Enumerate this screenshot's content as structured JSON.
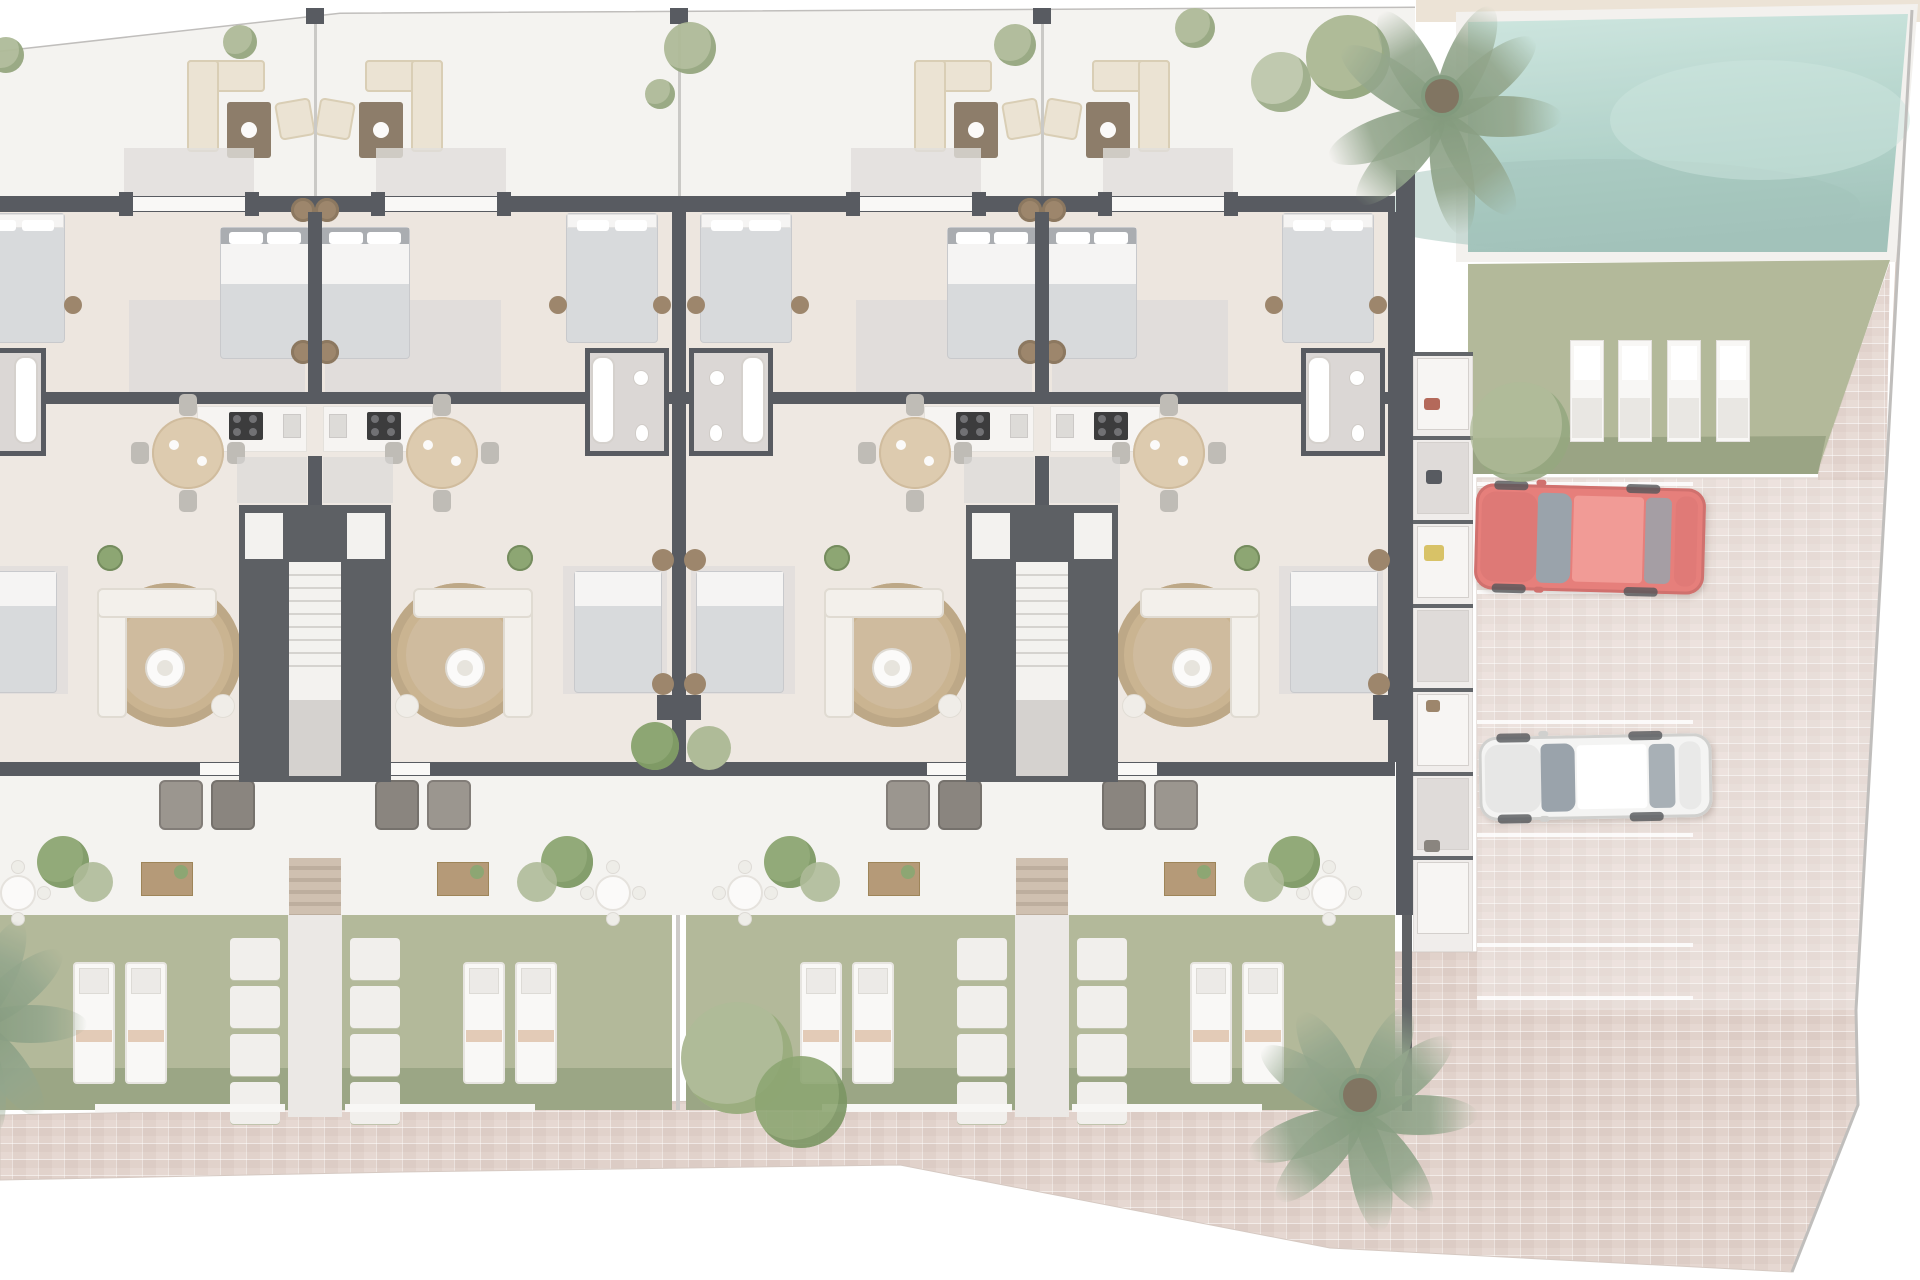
{
  "scene": {
    "type": "architectural-floor-plan",
    "view": "top-down 3d rendered site plan",
    "dwellings_visible": 4,
    "inventory": {
      "communal_pool": 1,
      "pool_sun_loungers": 4,
      "garden_sun_loungers_per_dwelling": 2,
      "cars": [
        {
          "color_name": "red"
        },
        {
          "color_name": "white"
        }
      ],
      "parking_stalls": 4,
      "palm_trees": 3,
      "double_beds_upper": 6,
      "stair_cores": 2,
      "round_dining_tables": 4,
      "round_rugs": 4
    }
  },
  "colors": {
    "page": "#ffffff",
    "terrace": "#f3f1ee",
    "terraceShadow": "#e3e0dd",
    "interiorBeige": "#eae2da",
    "interiorBeige2": "#ece5de",
    "grayFloor": "#d2d0d1",
    "wall": "#3d4047",
    "lightWall": "#f8f7f5",
    "porch": "#dcd9d6",
    "lawn": "#a7ae8a",
    "hedge": "#85926b",
    "bushBright": "#7b985c",
    "bushSoft": "#a2b088",
    "palm": "#82987a",
    "palmDark": "#6f8a68",
    "pathConcrete": "#e8e5e1",
    "steps": "#c8b6a3",
    "stone": "#efede9",
    "paving": "#dccbc3",
    "pavingLight": "#e7dad3",
    "poolRim": "#f1efec",
    "poolTop": "#c6e2da",
    "poolBottom": "#a5cbc1",
    "poolDeep": "#93b9af",
    "beigeStrip": "#e9dfd0",
    "boundary": "#b6b4b1",
    "bedDuvet": "#d2d4d7",
    "bedSheet": "#f4f3f1",
    "headboard": "#9da0a5",
    "nightstand": "#8d7354",
    "sofaBeige": "#e8dfcc",
    "sofaBeigeEdge": "#d3c6a9",
    "tableBrown": "#7b6852",
    "sideboard": "#a98a62",
    "armchairDark": "#77716a",
    "armchairDark2": "#8b857d",
    "rug": "#c7b08e",
    "rugEdge": "#b39a74",
    "diningTable": "#d8c3a2",
    "chairGray": "#b5b1ab",
    "white": "#fbfaf8",
    "counter": "#f5f3f0",
    "cooktop": "#1c1c1e",
    "stairLight": "#f2f0ed",
    "stairMid": "#cfcbc8",
    "bathFloor": "#d6d1ce",
    "redCar": "#e26a66",
    "redCarDark": "#c95a57",
    "glass": "#8a949e",
    "whiteCar": "#f3f3f2",
    "whiteCarEdge": "#d8d8d5",
    "loungerTowel": "#dcbda4",
    "curb": "#f7f6f4",
    "accentYellow": "#d2b84f",
    "accentRed": "#a8513f"
  },
  "layout": {
    "canvas": {
      "w": 1920,
      "h": 1280
    },
    "building": {
      "left": 0,
      "right": 1395,
      "clip": "0,52 340,14 1415,8 1415,1117 0,1117",
      "frontWallY": 196,
      "frontWallH": 16,
      "bedBandY": 212,
      "kitchenWallY": 392,
      "kitchenBandY": 404,
      "midWallY": 392,
      "rearWallY": 762,
      "patioY": 776,
      "gardenY": 915,
      "hedgeY": 1068,
      "gardenBottom": 1110,
      "curbY": 1106
    },
    "cores": [
      315,
      1042
    ],
    "separators": [
      {
        "x": -48,
        "sides": "right",
        "gardenBushes": false
      },
      {
        "x": 679,
        "sides": "both",
        "gardenBushes": true
      },
      {
        "x": 1395,
        "sides": "left",
        "gardenBushes": false
      }
    ],
    "terraceBushes": [
      [
        6,
        55,
        18
      ],
      [
        240,
        42,
        17
      ],
      [
        690,
        48,
        26
      ],
      [
        660,
        94,
        15
      ],
      [
        1015,
        45,
        21
      ],
      [
        1195,
        28,
        20
      ]
    ],
    "right": {
      "beigeStrip": {
        "x": 1416,
        "y": 0,
        "w": 504,
        "h": 22
      },
      "poolRim": "1456,12 1918,4 1896,262 1456,262",
      "pool": "1468,22 1908,14 1887,252 1468,252",
      "poolLawn": "1468,264 1890,260 1818,474 1468,474",
      "lawnWedge": "1890,262 1886,480 1818,480 1818,470",
      "hedgeStrip": "1468,438 1826,436 1818,474 1468,474",
      "poolLoungers": {
        "xs": [
          1570,
          1618,
          1667,
          1716
        ],
        "y": 340,
        "w": 34,
        "h": 102
      },
      "nicheStrip": {
        "x": 1413,
        "y": 352,
        "w": 60,
        "h": 600,
        "cells": 7
      },
      "buildingRightWall": {
        "x": 1396,
        "y": 170,
        "w": 20,
        "h": 745
      },
      "gardenRightWall": {
        "x": 1402,
        "y": 915,
        "w": 10,
        "h": 196
      },
      "stallLines": {
        "x": 1477,
        "w": 216,
        "ys": [
          482,
          590,
          720,
          833,
          943,
          996
        ]
      },
      "redCar": {
        "x": 1475,
        "y": 486,
        "w": 230,
        "h": 106,
        "rot": 1.5
      },
      "whiteCar": {
        "x": 1479,
        "y": 735,
        "w": 233,
        "h": 84,
        "rot": -1
      },
      "pavingPolygon": "0,1115 1360,1088 1360,952 1477,952 1477,478 1886,478 1896,262 1912,10 1886,480 1856,1010 1858,1105 1792,1272 1330,1248 900,1165 400,1172 0,1180",
      "boundaryLine": "1912,10 1886,480 1856,1010 1858,1105 1792,1272",
      "topLine": "0,52 340,14 1415,8",
      "palms": [
        {
          "cx": 1442,
          "cy": 96,
          "r": 120,
          "name": "pool-palm"
        },
        {
          "cx": 1360,
          "cy": 1095,
          "r": 118,
          "name": "paving-palm"
        },
        {
          "cx": -25,
          "cy": 1005,
          "r": 112,
          "name": "garden-palm"
        }
      ],
      "bushes": [
        {
          "cx": 1281,
          "cy": 82,
          "r": 30,
          "soft": true
        },
        {
          "cx": 1348,
          "cy": 57,
          "r": 42,
          "soft": false
        },
        {
          "cx": 1520,
          "cy": 432,
          "r": 50,
          "soft": true
        }
      ],
      "nicheItems": [
        {
          "x": 1424,
          "y": 398,
          "w": 16,
          "h": 12,
          "c": "accentRed"
        },
        {
          "x": 1426,
          "y": 470,
          "w": 16,
          "h": 14,
          "c": "wall"
        },
        {
          "x": 1424,
          "y": 545,
          "w": 20,
          "h": 16,
          "c": "accentYellow"
        },
        {
          "x": 1426,
          "y": 700,
          "w": 14,
          "h": 12,
          "c": "nightstand"
        },
        {
          "x": 1424,
          "y": 840,
          "w": 16,
          "h": 12,
          "c": "armchairDark"
        }
      ]
    }
  }
}
